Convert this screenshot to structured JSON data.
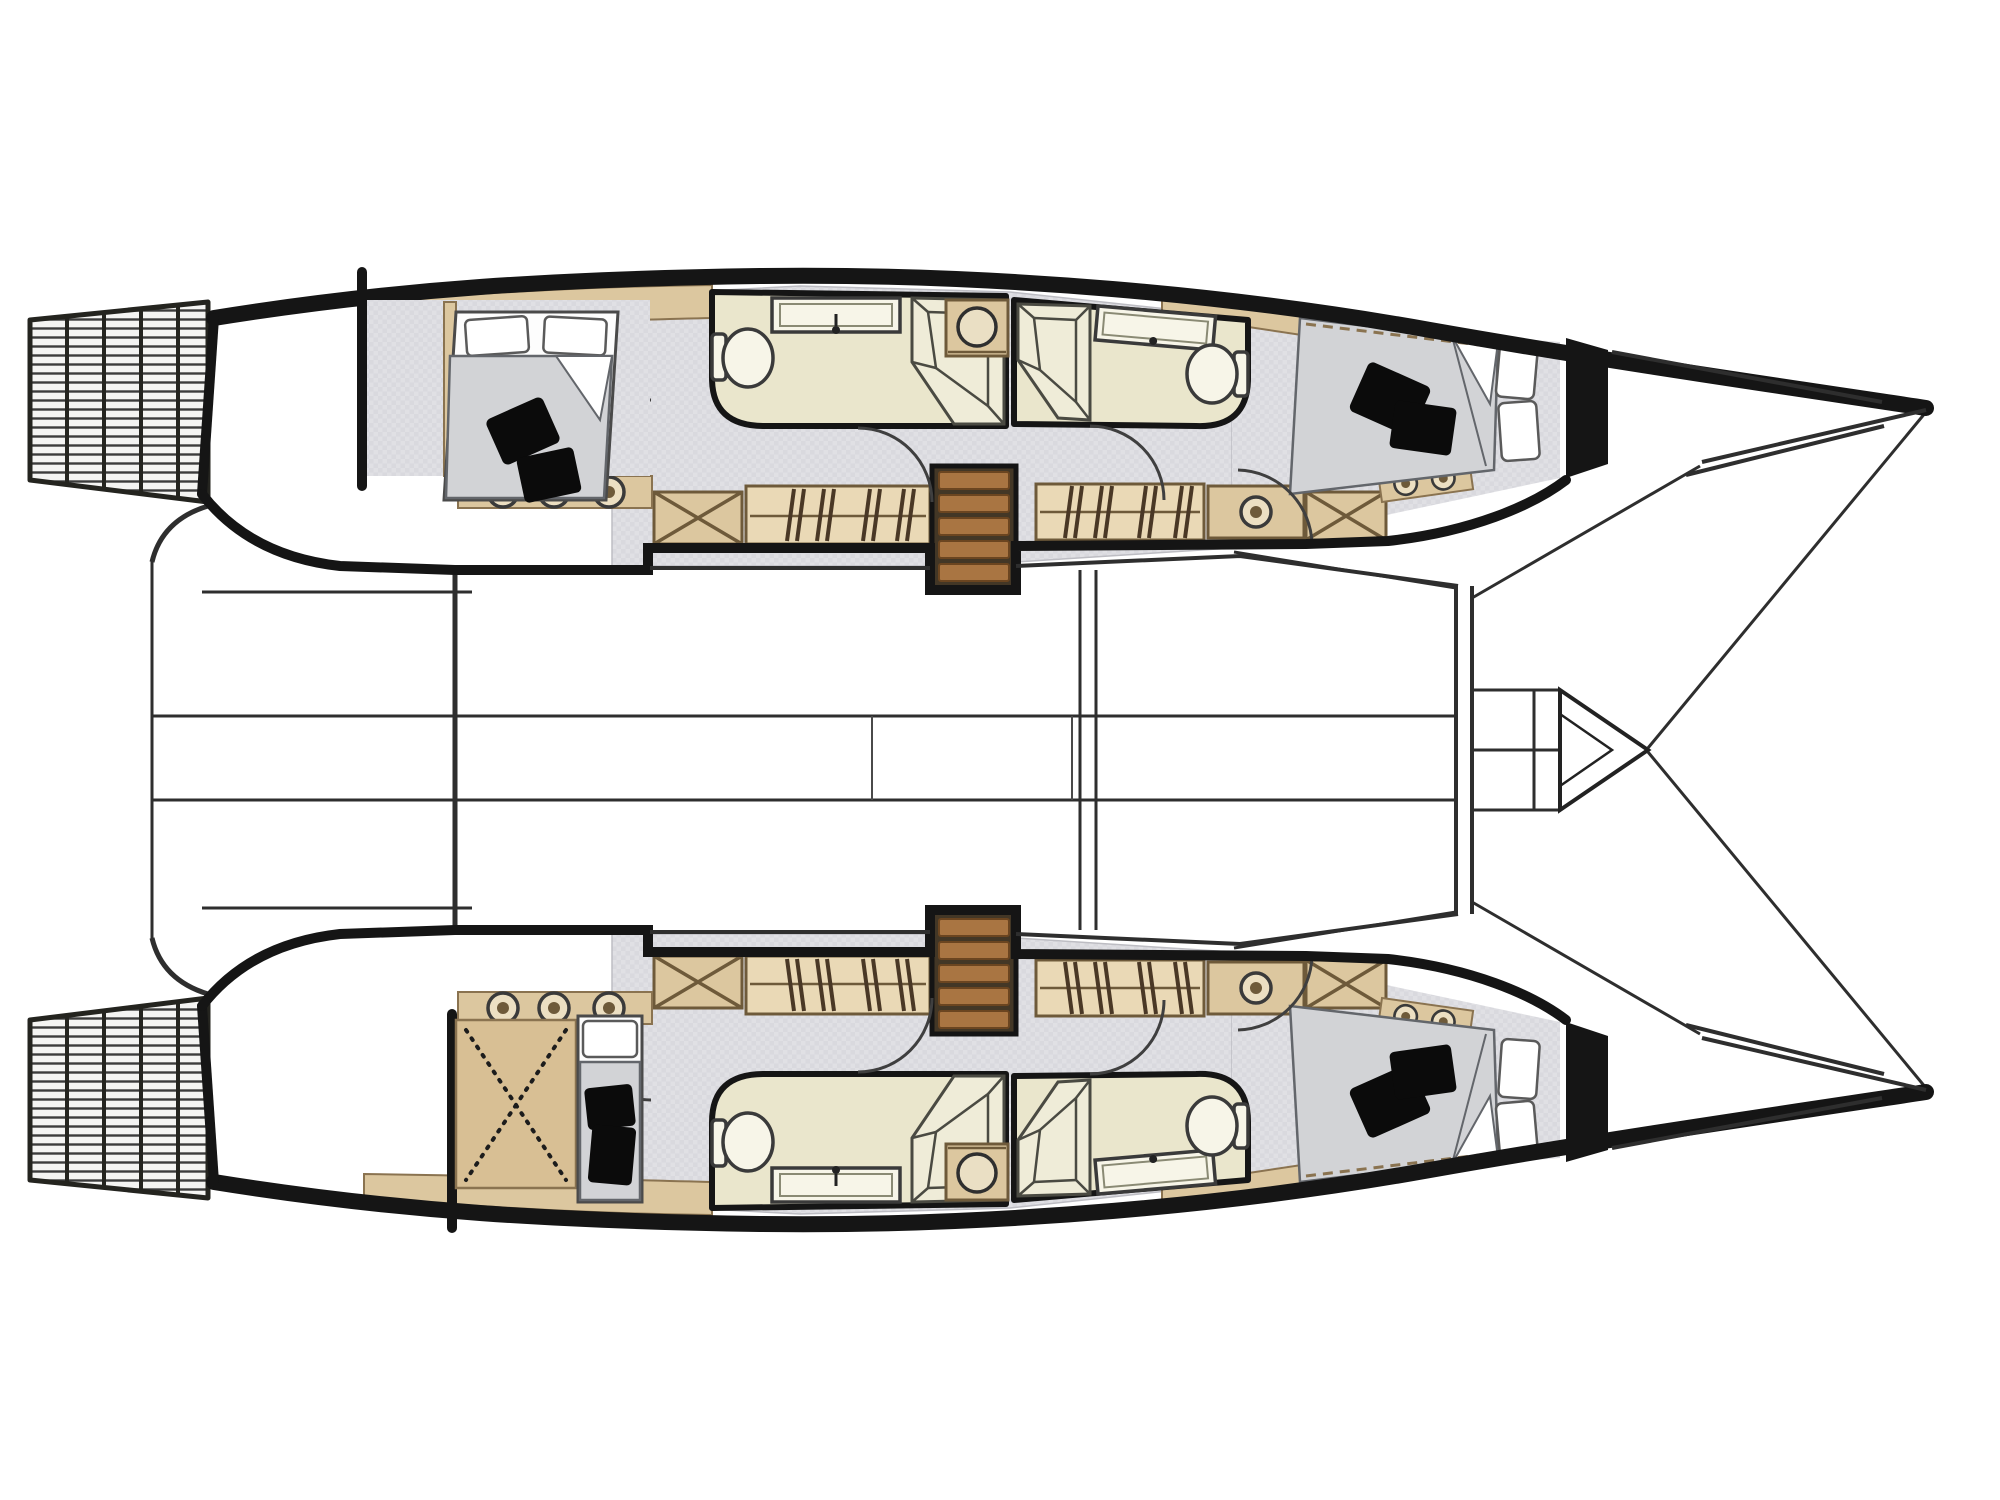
{
  "page": {
    "background": "#ffffff"
  },
  "diagram": {
    "type": "boat-floor-plan",
    "subject": "catamaran lower deck accommodation layout",
    "orientation": {
      "bows": "right",
      "sterns_with_steps": "left"
    },
    "description": "Top-down interior floor plan of a sailing catamaran: two symmetric hulls, each with aft and forward cabins, two bathrooms, hanging lockers and companionway stairs, joined by a bridge deck with cockpit lines, mast beam, forward crossbeam and pointed bowsprit."
  },
  "colors": {
    "ink": "#151515",
    "line": "#2e2e2e",
    "floor": "#e0e0e4",
    "duvet": "#d2d3d6",
    "bath": "#eae6cc",
    "fixture": "#f7f5e8",
    "tan": "#dcc79f",
    "tan_light": "#ead9b6",
    "tan_dark": "#d8bf94",
    "tan_line": "#6e5a3a",
    "wood": "#a97542",
    "wood_dark": "#6b4520",
    "cushion": "#0b0b0b",
    "bg": "#ffffff"
  },
  "port_hull": {
    "position": "top",
    "transom": "5-step swim platform ladder",
    "aft_cabin": {
      "bed": "double bed",
      "pillows": 2,
      "black_cushions": 2
    },
    "aft_head": [
      "toilet",
      "vanity sink",
      "corner shower"
    ],
    "appliance": "front-loading washer",
    "forward_head": [
      "corner shower",
      "vanity sink",
      "toilet"
    ],
    "forward_cabin": {
      "bed": "double bed",
      "pillows": 2,
      "black_cushions": 2
    },
    "storage": [
      "x-front locker",
      "hanging locker",
      "hanging locker",
      "shelf locker",
      "x-front locker"
    ],
    "stairs": "companionway with 5 treads",
    "portholes": 6
  },
  "starboard_hull": {
    "position": "bottom",
    "transom": "5-step swim platform ladder",
    "aft_area": {
      "technical_space": "dashed-X storage/technical area",
      "bed": "single berth",
      "pillows": 1,
      "black_cushions": 2
    },
    "aft_head": [
      "toilet",
      "vanity sink",
      "corner shower"
    ],
    "appliance": "front-loading washer",
    "forward_head": [
      "corner shower",
      "vanity sink",
      "toilet"
    ],
    "forward_cabin": {
      "bed": "double bed",
      "pillows": 2,
      "black_cushions": 2
    },
    "storage": [
      "x-front locker",
      "hanging locker",
      "hanging locker",
      "shelf locker",
      "x-front locker"
    ],
    "stairs": "companionway with 5 treads",
    "portholes": 6
  },
  "bridge_deck": {
    "elements": [
      "aft cockpit outline",
      "stern platform line",
      "walkway lines",
      "saloon sole lines",
      "mast beam lines",
      "forward crossbeam",
      "bowsprit with bow bridle lines"
    ]
  }
}
